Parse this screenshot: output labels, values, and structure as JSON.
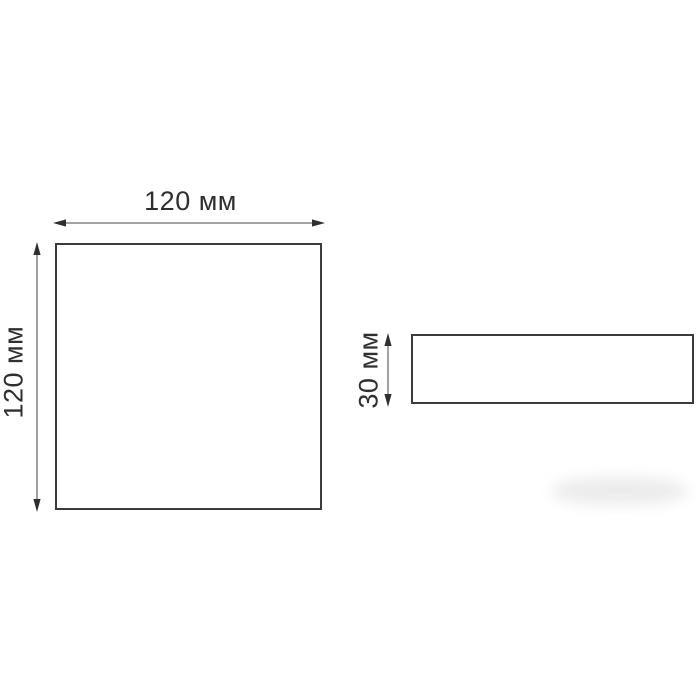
{
  "diagram": {
    "background_color": "#ffffff",
    "outline_color": "#3b3b3b",
    "dimension_line_color": "#6e6e6e",
    "text_color": "#2f2f2f",
    "front_view": {
      "width_label": "120 мм",
      "height_label": "120 мм",
      "width_mm": 120,
      "height_mm": 120
    },
    "side_view": {
      "height_label": "30 мм",
      "height_mm": 30
    }
  }
}
